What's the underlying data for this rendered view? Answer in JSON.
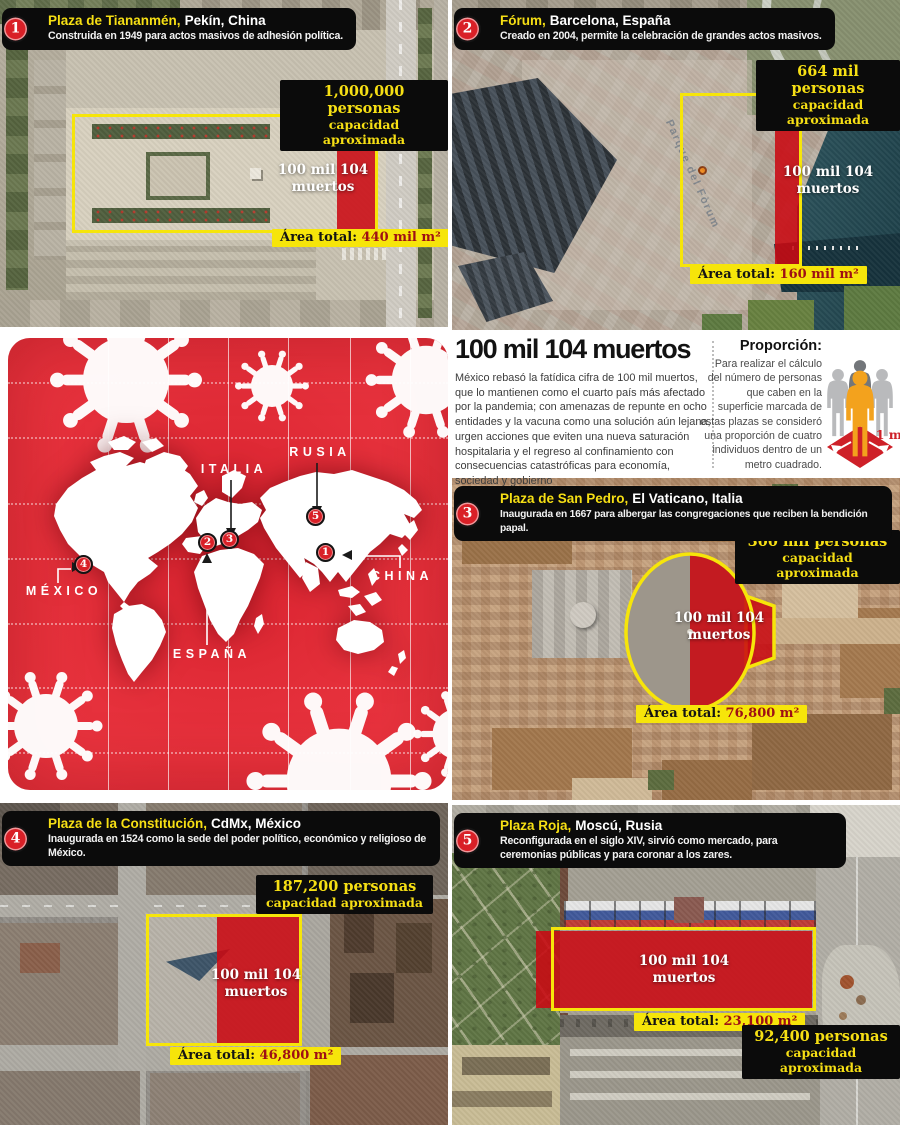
{
  "headline": {
    "title": "100 mil 104 muertos",
    "body": "México rebasó la fatídica cifra de 100 mil muertos, que lo mantienen como el cuarto país más afectado por la pandemia; con amenazas de repunte en ocho entidades y la vacuna como una solución aún lejana, urgen acciones que eviten una nueva saturación hospitalaria y el regreso al confinamiento con consecuencias catastróficas para economía, sociedad y gobierno"
  },
  "proportion": {
    "title": "Proporción:",
    "text": "Para realizar el cálculo del número de personas que caben en la superficie marcada de estas plazas se consideró una proporción de cuatro individuos dentro de un metro cuadrado.",
    "scale_label": "1 m"
  },
  "deaths_overlay": {
    "line1": "100 mil 104",
    "line2": "muertos"
  },
  "shared": {
    "capacity_sub": "capacidad aproximada",
    "area_label": "Área total:"
  },
  "map": {
    "countries": [
      {
        "name": "MÉXICO",
        "marker": "4"
      },
      {
        "name": "ESPAÑA",
        "marker": "2"
      },
      {
        "name": "ITALIA",
        "marker": "3"
      },
      {
        "name": "RUSIA",
        "marker": "5"
      },
      {
        "name": "CHINA",
        "marker": "1"
      }
    ]
  },
  "panels": [
    {
      "number": "1",
      "name": "Plaza de Tiananmén,",
      "location": "Pekín, China",
      "description": "Construida en 1949 para actos masivos de adhesión política.",
      "capacity": "1,000,000 personas",
      "area_value": "440 mil m²"
    },
    {
      "number": "2",
      "name": "Fórum,",
      "location": "Barcelona, España",
      "description": "Creado en 2004, permite la celebración de grandes actos masivos.",
      "capacity": "664 mil personas",
      "area_value": "160 mil m²",
      "map_place_label": "Parque del Fòrum"
    },
    {
      "number": "3",
      "name": "Plaza de San Pedro,",
      "location": "El Vaticano, Italia",
      "description": "Inaugurada en 1667 para albergar las congregaciones que reciben la bendición papal.",
      "capacity": "300 mil personas",
      "area_value": "76,800 m²"
    },
    {
      "number": "4",
      "name": "Plaza de la Constitución,",
      "location": "CdMx, México",
      "description": "Inaugurada en 1524 como la sede del poder político, económico y religioso de México.",
      "capacity": "187,200 personas",
      "area_value": "46,800 m²"
    },
    {
      "number": "5",
      "name": "Plaza Roja,",
      "location": "Moscú, Rusia",
      "description": "Reconfigurada en el siglo XIV, sirvió como mercado, para ceremonias públicas y para coronar a los zares.",
      "capacity": "92,400 personas",
      "area_value": "23,100 m²"
    }
  ],
  "colors": {
    "accent_red": "#d92027",
    "accent_yellow": "#f6e50a",
    "overlay_red": "#c90912",
    "box_black": "#0b0b0b"
  }
}
